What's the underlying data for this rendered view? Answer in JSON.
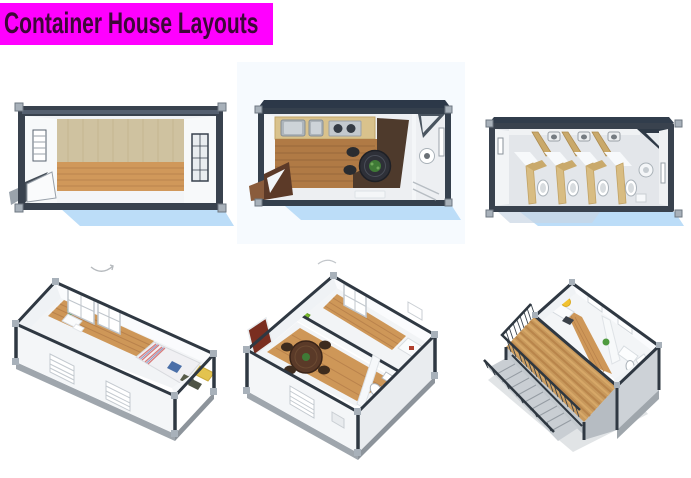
{
  "canvas": {
    "width": 691,
    "height": 478,
    "background": "#FFFFFF"
  },
  "header": {
    "title": "Container House Layouts",
    "bg_color": "#FF00FF",
    "text_color": "#3D0838"
  },
  "gallery": {
    "rows": 2,
    "cols": 3,
    "items": [
      {
        "name": "empty-container-unit-top-view"
      },
      {
        "name": "kitchen-dining-unit-top-view"
      },
      {
        "name": "toilet-sanitary-unit-top-view"
      },
      {
        "name": "bedroom-unit-isometric-view"
      },
      {
        "name": "two-room-living-unit-isometric-view"
      },
      {
        "name": "two-storey-unit-with-deck-and-stairs-isometric-view"
      }
    ],
    "palette": {
      "frame": "#39424E",
      "wall": "#F3F5F7",
      "wood": "#CE9758",
      "wood_dark": "#B9824C",
      "deck_wood": "#C8995C",
      "shadow_blue": "#BCDDF8",
      "corner_casting": "#A8B1BA",
      "table_dark": "#2E3038",
      "plant_green": "#3F7A36",
      "lamp_yellow": "#F2C230"
    }
  }
}
